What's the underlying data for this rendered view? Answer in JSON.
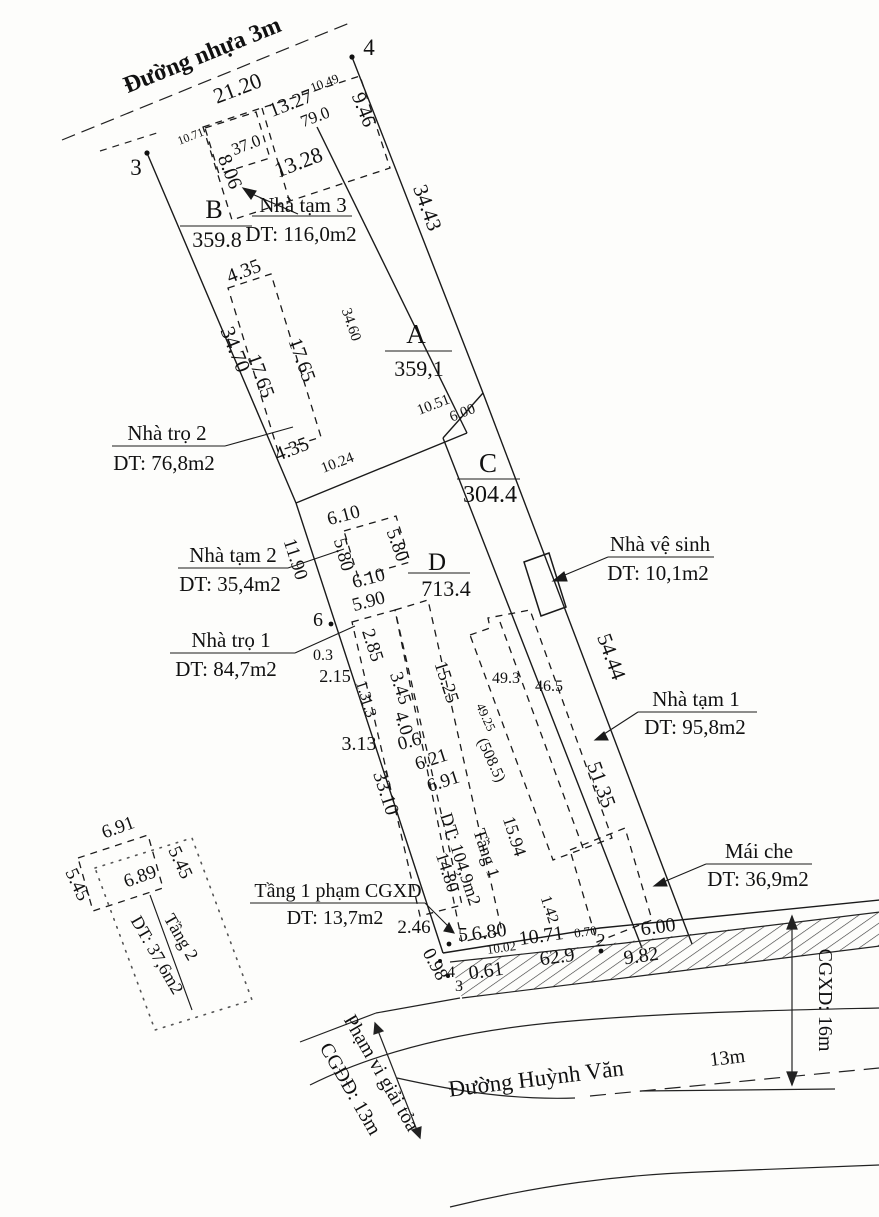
{
  "roads": {
    "top": "Đường nhựa 3m",
    "bottom": "Đường Huỳnh Văn",
    "bottom_width": "13m"
  },
  "annotations": {
    "cgxd_16m": "CGXD: 16m",
    "cgdd_13m": "CGĐĐ: 13m",
    "pham_vi": "Phạm vi giải tỏa"
  },
  "parcels": {
    "a": {
      "id": "A",
      "area": "359,1"
    },
    "b": {
      "id": "B",
      "area": "359.8"
    },
    "c": {
      "id": "C",
      "area": "304.4"
    },
    "d": {
      "id": "D",
      "area": "713.4"
    }
  },
  "buildings": {
    "nha_tam_3": {
      "name": "Nhà tạm 3",
      "dt": "DT: 116,0m2"
    },
    "nha_tro_2": {
      "name": "Nhà trọ 2",
      "dt": "DT: 76,8m2"
    },
    "nha_tam_2": {
      "name": "Nhà tạm 2",
      "dt": "DT: 35,4m2"
    },
    "nha_tro_1": {
      "name": "Nhà trọ 1",
      "dt": "DT: 84,7m2"
    },
    "nha_ve_sinh": {
      "name": "Nhà vệ sinh",
      "dt": "DT: 10,1m2"
    },
    "nha_tam_1": {
      "name": "Nhà tạm 1",
      "dt": "DT: 95,8m2"
    },
    "mai_che": {
      "name": "Mái che",
      "dt": "DT: 36,9m2"
    },
    "tang_1": {
      "name": "Tầng 1",
      "dt": "DT: 104,9m2"
    },
    "tang_2": {
      "name": "Tầng 2",
      "dt": "DT: 37,6m2"
    },
    "tang_1_pham": {
      "name": "Tầng 1 phạm CGXD",
      "dt": "DT: 13,7m2"
    }
  },
  "points": {
    "p2": "2",
    "p3": "3",
    "p4": "4",
    "p5": "5",
    "p6": "6",
    "p4b": "4",
    "p3b": "3"
  },
  "dims": {
    "d21_20": "21.20",
    "d13_27": "13.27",
    "d10_49": "10.49",
    "d9_46": "9.46",
    "a79_0": "79.0",
    "d10_71_top": "10.71",
    "a37_0": "37.0",
    "d8_06": "8.06",
    "d13_28": "13.28",
    "d34_43": "34.43",
    "d34_70": "34.70",
    "d34_60": "34.60",
    "d4_35_top": "4.35",
    "d17_65_in": "17.65",
    "d17_65_out": "17.65",
    "d4_35_bot": "4.35",
    "d10_24": "10.24",
    "d10_51": "10.51",
    "d6_00_top": "6.00",
    "d6_10_top": "6.10",
    "d5_80_r": "5.80",
    "d5_80_l": "5.80",
    "d6_10_bot": "6.10",
    "d11_90": "11.90",
    "d5_90": "5.90",
    "d2_85": "2.85",
    "d0_3": "0.3",
    "d2_15": "2.15",
    "d1_3_a": "1.3",
    "d3_45": "3.45",
    "d1_3_b": "1.3",
    "d4_0": "4.0",
    "d0_6": "0.6",
    "d6_21": "6.21",
    "d6_91": "6.91",
    "d3_13": "3.13",
    "d33_10": "33.10",
    "d15_25": "15.25",
    "d49_25": "49.25",
    "a508_5": "(508.5)",
    "a49_3": "49.3",
    "a46_5": "46.5",
    "d54_44": "54.44",
    "d51_35": "51.35",
    "d15_94": "15.94",
    "d14_80": "14.80",
    "d1_42": "1.42",
    "d6_91_t2": "6.91",
    "d5_45_r": "5.45",
    "d5_45_l": "5.45",
    "d6_89": "6.89",
    "d2_46": "2.46",
    "d0_98": "0.98",
    "d6_80": "6.80",
    "d10_02": "10.02",
    "d10_71_bot": "10.71",
    "d0_70": "0.70",
    "d6_00_bot": "6.00",
    "d0_61": "0.61",
    "a62_9": "62.9",
    "d9_82": "9.82"
  }
}
